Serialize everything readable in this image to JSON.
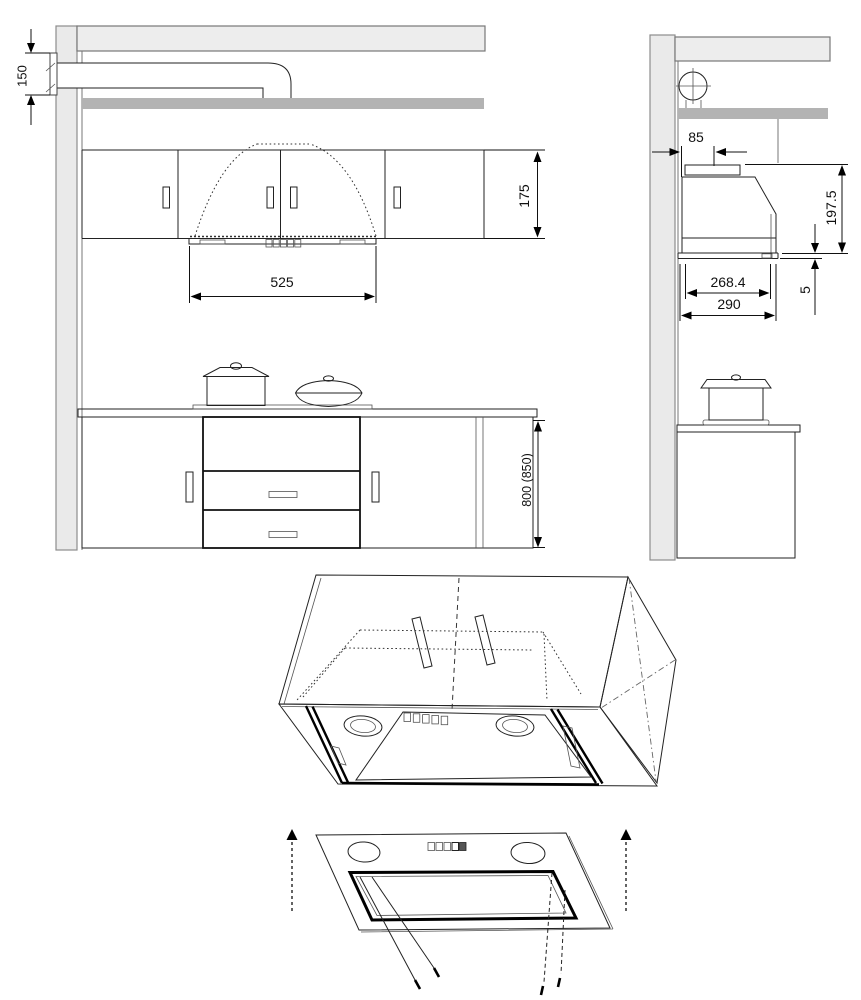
{
  "dims": {
    "wall_duct_height": "150",
    "upper_cabinet_height": "175",
    "cutout_width": "525",
    "worktop_height": "800 (850)",
    "top_rear_offset": "85",
    "hood_height": "197.5",
    "bottom_gap": "5",
    "body_depth": "268.4",
    "overall_depth": "290"
  },
  "colors": {
    "wall_fill": "#eaeaea",
    "wall_stroke": "#8c8c8c",
    "ceiling_fill": "#ededed",
    "ceiling_stroke": "#777777",
    "soffit_fill": "#b3b3b3"
  }
}
